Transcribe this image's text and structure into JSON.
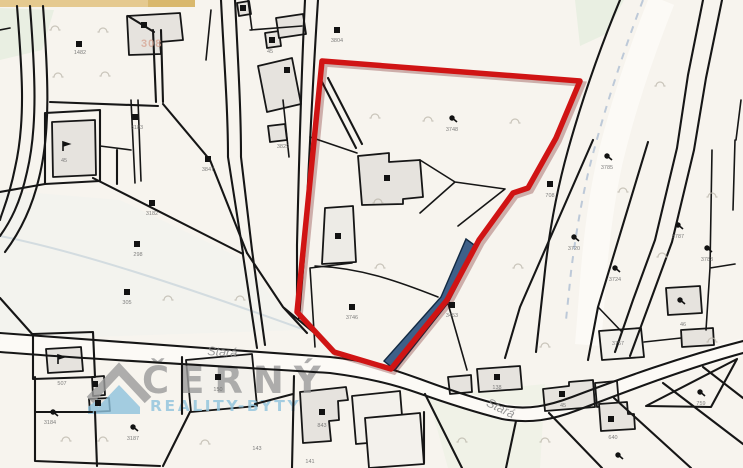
{
  "map": {
    "title": "cadastral-map",
    "street_labels": [
      {
        "text": "Stará",
        "x": 222,
        "y": 356,
        "rotate": 4
      },
      {
        "text": "Stará",
        "x": 499,
        "y": 412,
        "rotate": 26
      }
    ],
    "watermark": {
      "brand": "ČERNÝ",
      "tagline": "REALITY-BYTY",
      "house_icon": "house-icon"
    },
    "register_number": {
      "text": "308",
      "x": 141,
      "y": 47
    },
    "parcel_labels": [
      {
        "x": 80,
        "y": 54,
        "text": "1482"
      },
      {
        "x": 137,
        "y": 129,
        "text": "3183"
      },
      {
        "x": 64,
        "y": 162,
        "text": "45"
      },
      {
        "x": 208,
        "y": 171,
        "text": "3847"
      },
      {
        "x": 152,
        "y": 215,
        "text": "3182"
      },
      {
        "x": 138,
        "y": 256,
        "text": "298"
      },
      {
        "x": 127,
        "y": 304,
        "text": "305"
      },
      {
        "x": 283,
        "y": 148,
        "text": "3829"
      },
      {
        "x": 337,
        "y": 42,
        "text": "3804"
      },
      {
        "x": 270,
        "y": 53,
        "text": "45"
      },
      {
        "x": 352,
        "y": 319,
        "text": "3746"
      },
      {
        "x": 452,
        "y": 131,
        "text": "3748"
      },
      {
        "x": 452,
        "y": 317,
        "text": "3453"
      },
      {
        "x": 550,
        "y": 197,
        "text": "708"
      },
      {
        "x": 574,
        "y": 250,
        "text": "3720"
      },
      {
        "x": 615,
        "y": 281,
        "text": "3724"
      },
      {
        "x": 678,
        "y": 238,
        "text": "3787"
      },
      {
        "x": 707,
        "y": 261,
        "text": "3783"
      },
      {
        "x": 607,
        "y": 169,
        "text": "3785"
      },
      {
        "x": 683,
        "y": 326,
        "text": "46"
      },
      {
        "x": 50,
        "y": 424,
        "text": "3184"
      },
      {
        "x": 133,
        "y": 440,
        "text": "3187"
      },
      {
        "x": 62,
        "y": 385,
        "text": "507"
      },
      {
        "x": 218,
        "y": 391,
        "text": "150"
      },
      {
        "x": 322,
        "y": 427,
        "text": "843"
      },
      {
        "x": 257,
        "y": 450,
        "text": "143"
      },
      {
        "x": 310,
        "y": 463,
        "text": "141"
      },
      {
        "x": 497,
        "y": 389,
        "text": "138"
      },
      {
        "x": 563,
        "y": 407,
        "text": "45"
      },
      {
        "x": 613,
        "y": 439,
        "text": "640"
      },
      {
        "x": 701,
        "y": 405,
        "text": "759"
      },
      {
        "x": 618,
        "y": 345,
        "text": "3757"
      }
    ],
    "building_marks": [
      [
        79,
        44
      ],
      [
        144,
        25
      ],
      [
        287,
        70
      ],
      [
        337,
        30
      ],
      [
        243,
        8
      ],
      [
        272,
        40
      ],
      [
        135,
        117
      ],
      [
        208,
        159
      ],
      [
        152,
        203
      ],
      [
        137,
        244
      ],
      [
        127,
        292
      ],
      [
        352,
        307
      ],
      [
        452,
        305
      ],
      [
        550,
        184
      ],
      [
        387,
        178
      ],
      [
        338,
        236
      ],
      [
        218,
        377
      ],
      [
        95,
        384
      ],
      [
        98,
        403
      ],
      [
        322,
        412
      ],
      [
        497,
        377
      ],
      [
        562,
        394
      ],
      [
        611,
        419
      ]
    ],
    "flag_marks": [
      [
        63,
        146
      ],
      [
        58,
        359
      ]
    ],
    "tree_marks": [
      [
        452,
        118
      ],
      [
        574,
        237
      ],
      [
        615,
        268
      ],
      [
        678,
        225
      ],
      [
        707,
        248
      ],
      [
        607,
        156
      ],
      [
        680,
        300
      ],
      [
        700,
        392
      ],
      [
        618,
        455
      ],
      [
        133,
        427
      ],
      [
        53,
        412
      ]
    ],
    "arc_marks": [
      [
        55,
        30
      ],
      [
        103,
        32
      ],
      [
        58,
        77
      ],
      [
        105,
        76
      ],
      [
        375,
        118
      ],
      [
        428,
        121
      ],
      [
        515,
        123
      ],
      [
        378,
        203
      ],
      [
        380,
        268
      ],
      [
        518,
        268
      ],
      [
        660,
        86
      ],
      [
        623,
        192
      ],
      [
        712,
        197
      ],
      [
        662,
        257
      ],
      [
        712,
        342
      ],
      [
        545,
        347
      ],
      [
        462,
        442
      ],
      [
        545,
        442
      ],
      [
        66,
        441
      ],
      [
        103,
        441
      ],
      [
        205,
        444
      ],
      [
        168,
        300
      ],
      [
        240,
        300
      ]
    ]
  },
  "colors": {
    "highlight": "#d01414",
    "stream": "#3e6089",
    "wm-brand": "#9b9b9b",
    "wm-tag": "#8fc3dd",
    "reg": "#d8a795"
  }
}
